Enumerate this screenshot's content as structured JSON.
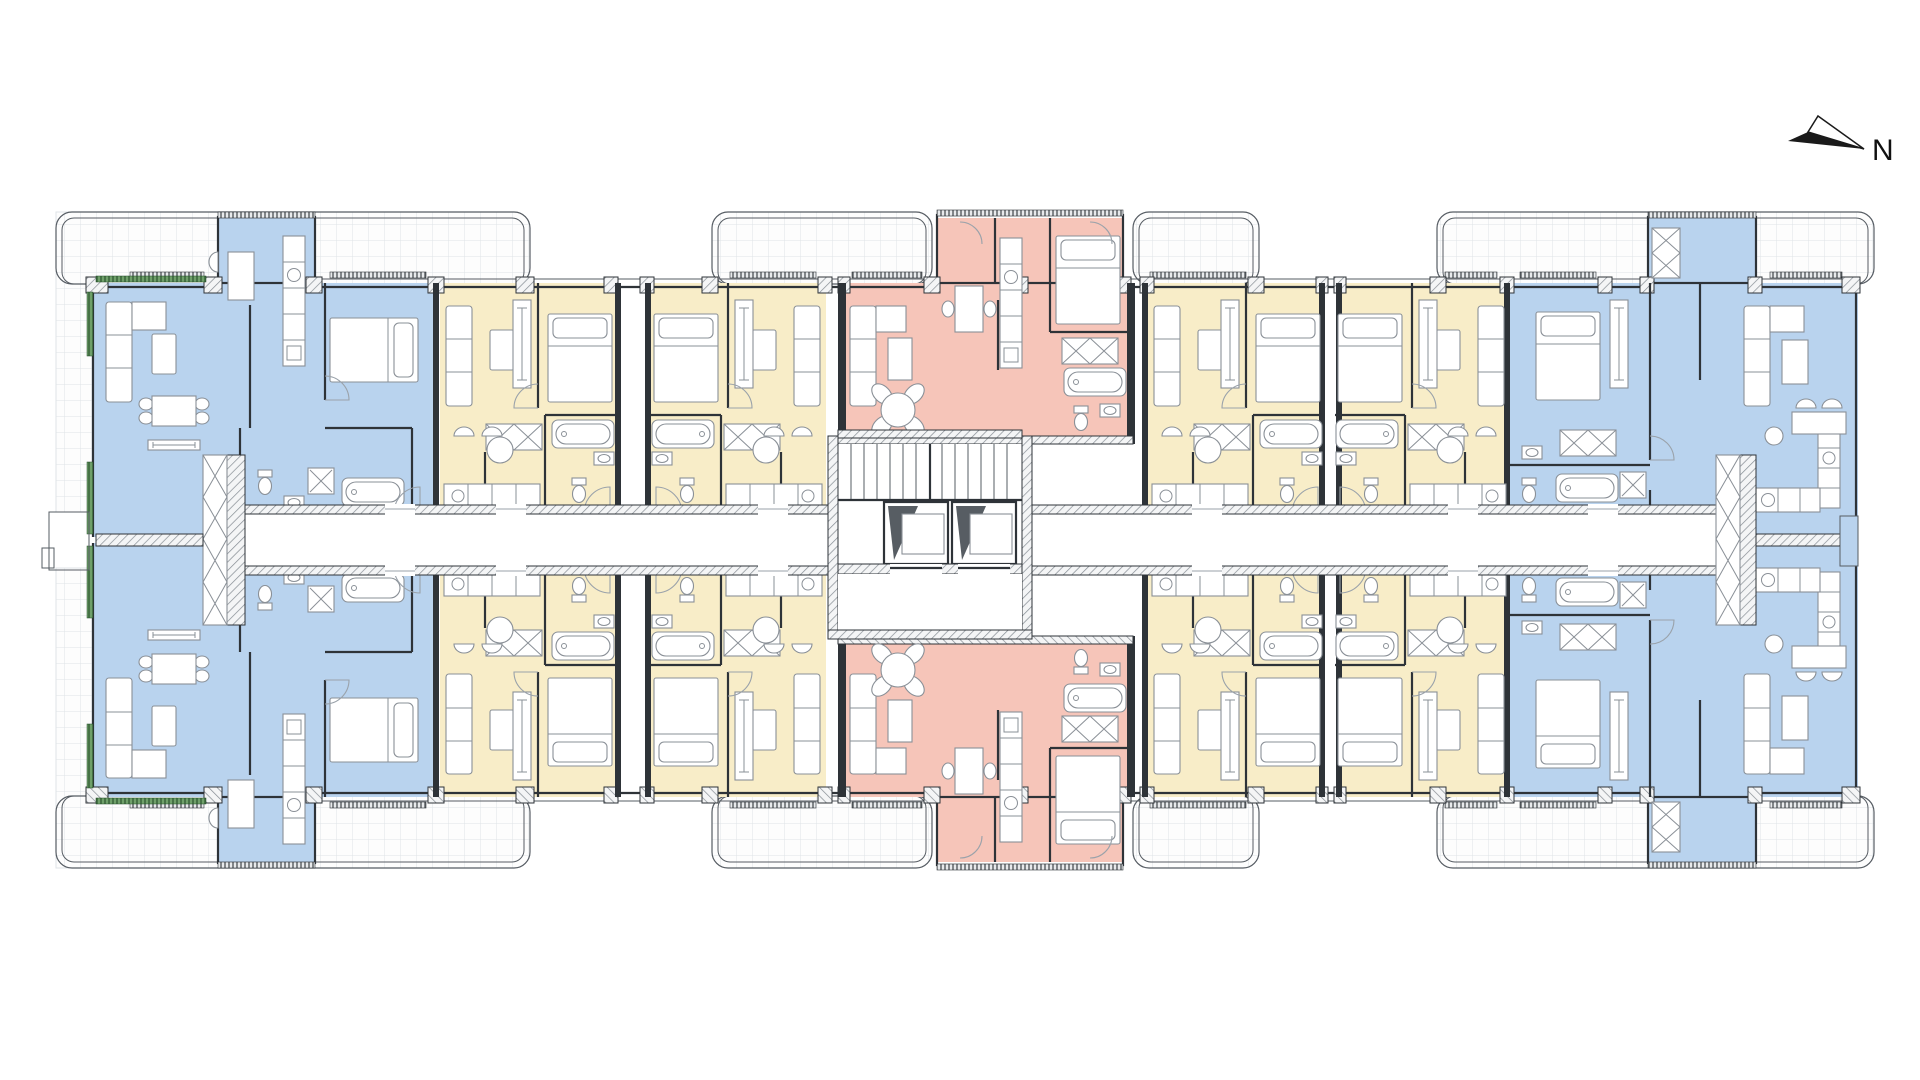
{
  "compass": {
    "label": "N"
  },
  "colors": {
    "unit-blue": "#b9d3ee",
    "unit-yellow": "#f8edc8",
    "unit-pink": "#f6c5b9",
    "wall": "#2e3338",
    "wall-mid": "#565c63",
    "furniture-stroke": "#8a9097",
    "tile-line": "#dfe3e7",
    "hatch-line": "#868d94",
    "green-accent": "#6fa06a",
    "green-tick": "#234d28",
    "elevator-dark": "#575d63",
    "paper": "#ffffff"
  },
  "plan": {
    "kind": "apartment-building-floor-plan",
    "corridor": "central double-loaded corridor",
    "core": {
      "stairs": 1,
      "elevators": 2
    },
    "unit_color_zones": [
      {
        "zone": "west-end",
        "color_key": "unit-blue",
        "units": 2
      },
      {
        "zone": "west-mid",
        "color_key": "unit-yellow",
        "units": 4
      },
      {
        "zone": "center",
        "color_key": "unit-pink",
        "units": 2
      },
      {
        "zone": "east-mid",
        "color_key": "unit-yellow",
        "units": 4
      },
      {
        "zone": "east-end",
        "color_key": "unit-blue",
        "units": 2
      }
    ],
    "balconies": "tiled terraces with rounded corners along north and south facades and building ends"
  }
}
